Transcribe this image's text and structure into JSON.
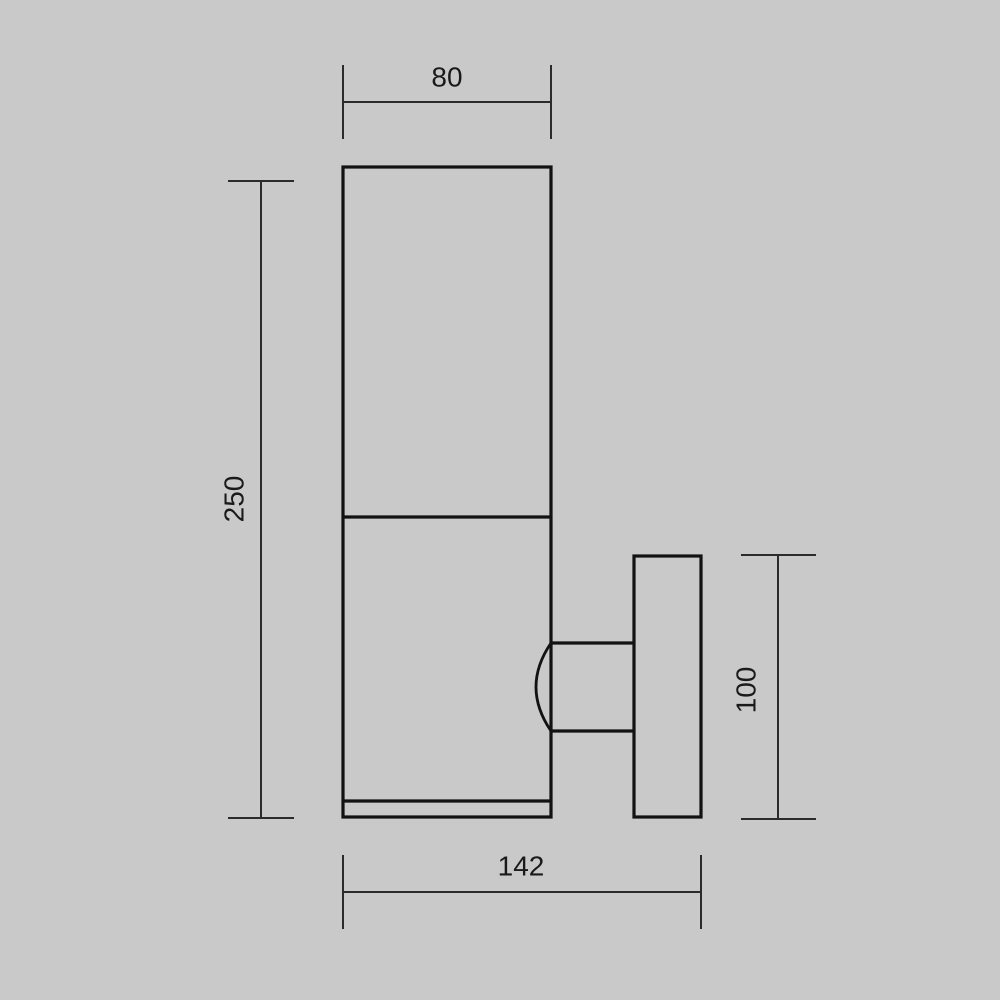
{
  "colors": {
    "background": "#c9c9c9",
    "object_line": "#121212",
    "dimension_line": "#2b2b2b",
    "label_text": "#1a1a1a"
  },
  "dimensions": {
    "top_width": {
      "label": "80"
    },
    "left_height": {
      "label": "250"
    },
    "right_plate_height": {
      "label": "100"
    },
    "bottom_depth": {
      "label": "142"
    }
  }
}
